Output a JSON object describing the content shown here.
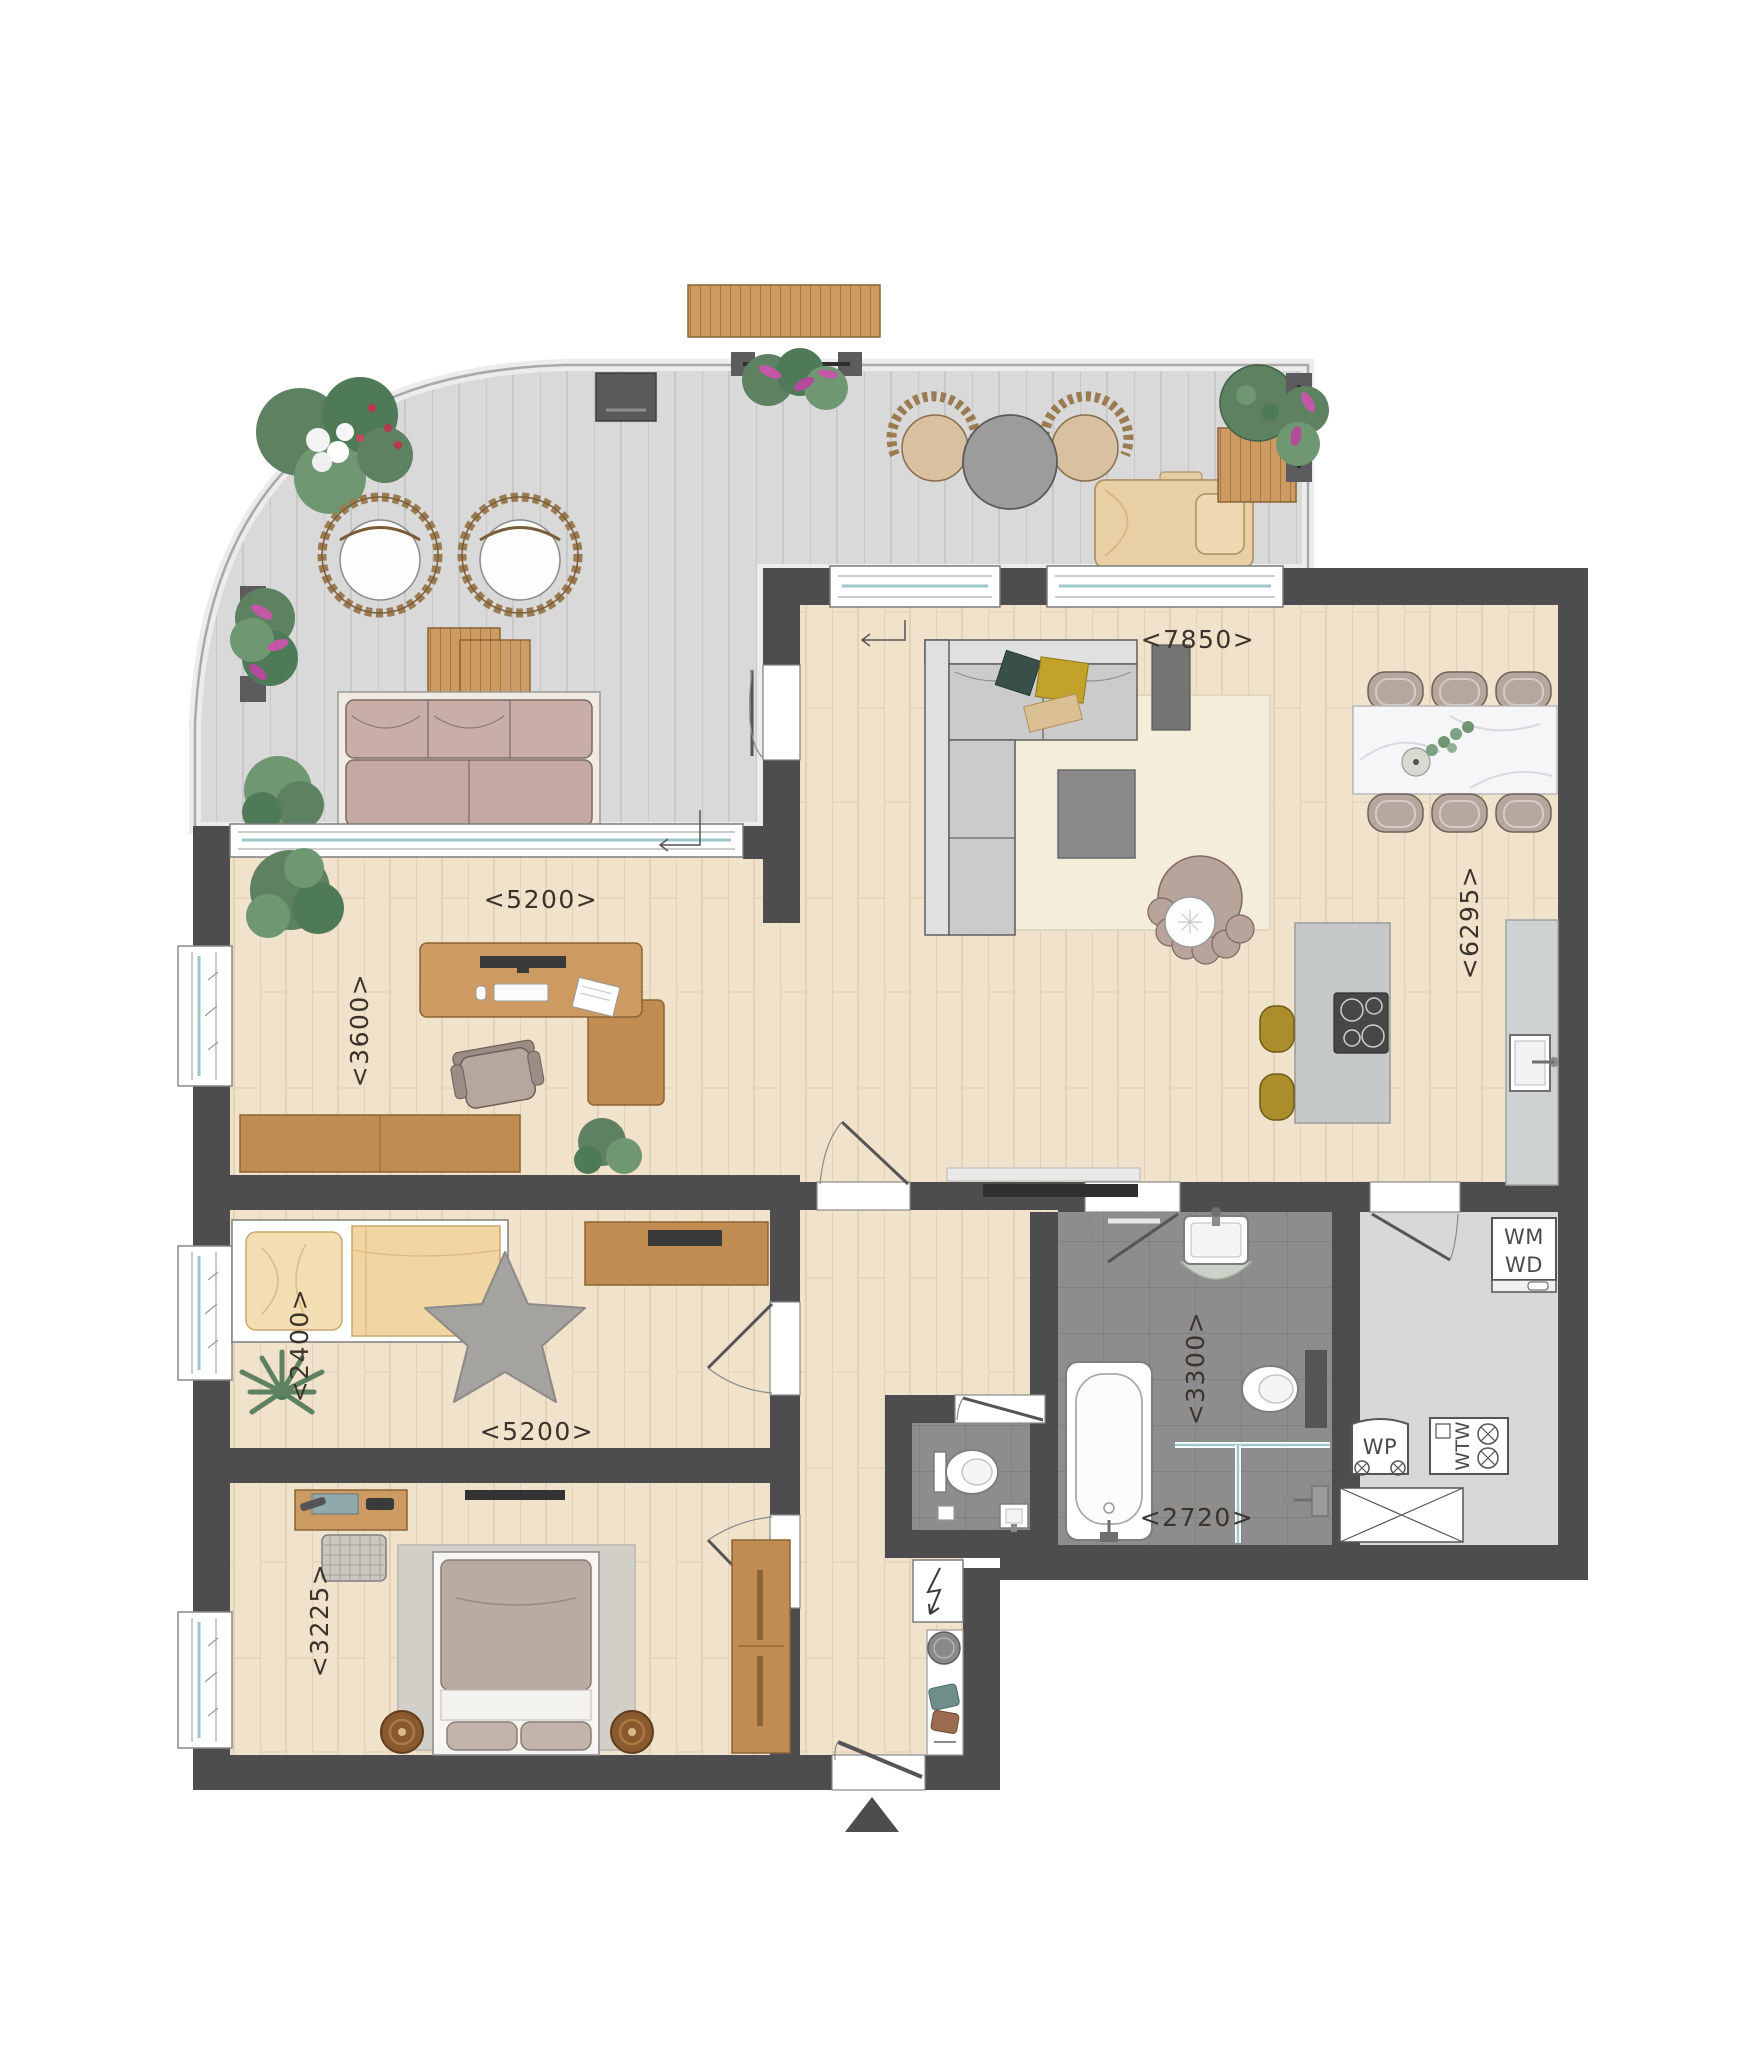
{
  "dims": {
    "living_width": "<7850>",
    "kitchen_depth": "<6295>",
    "office_width": "<5200>",
    "office_depth": "<3600>",
    "kids_depth": "<2400>",
    "kids_width": "<5200>",
    "master_depth": "<3225>",
    "bath_depth": "<3300>",
    "bath_width": "<2720>"
  },
  "tech_labels": {
    "washer": "WM",
    "dryer": "WD",
    "heat_pump": "WP",
    "heat_recovery": "WTW"
  },
  "colors": {
    "wall": "#4d4d4f",
    "wood_floor": "#f0e2cb",
    "terrace_deck": "#d9d9d9",
    "bathroom_tile": "#8d8d8d",
    "tech_floor": "#d8d8d6",
    "glass": "#9fc6c9",
    "flower_pink": "#c457a8",
    "stool_mustard": "#ab8d2c",
    "label_ink": "#3b332c"
  }
}
